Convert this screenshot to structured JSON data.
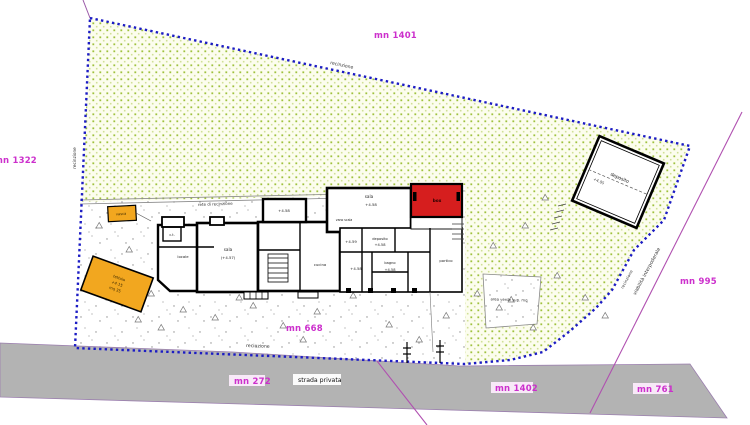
{
  "labels": {
    "mn_1401": "mn 1401",
    "mn_1322": "mn 1322",
    "mn_995": "mn 995",
    "mn_668": "mn 668",
    "mn_272": "mn 272",
    "mn_1402": "mn 1402",
    "mn_761": "mn 761"
  },
  "roads": {
    "strada_privata": "strada privata",
    "viabilita_interpoderale": "viabilità interpoderale"
  },
  "fence": {
    "recinzione_top": "recinzione",
    "recinzione_left": "recinzione",
    "recinzione_bottom": "recinzione",
    "recinzione_right": "recinzione",
    "rete_di_recinzione": "rete di recinzione"
  },
  "green_patch_note": "area verde sup. mq",
  "rooms": [
    {
      "text": "c.t."
    },
    {
      "text": "locale"
    },
    {
      "text": "sala"
    },
    {
      "text": "(+4.57)"
    },
    {
      "text": "+4.58"
    },
    {
      "text": "cucina"
    },
    {
      "text": "vano scala"
    },
    {
      "text": "sala"
    },
    {
      "text": "+4.58"
    },
    {
      "text": "+4.59"
    },
    {
      "text": "deposito"
    },
    {
      "text": "+4.58"
    },
    {
      "text": "+4.58"
    },
    {
      "text": "bagno"
    },
    {
      "text": "+4.58"
    },
    {
      "text": "portico"
    },
    {
      "text": "box"
    }
  ],
  "outbuildings": {
    "garage_label": "deposito",
    "garage_level": "+4.05",
    "tank_label": "vasca",
    "shed_line1": "tettoia",
    "shed_line2": "+4.15",
    "shed_line3": "mq 35"
  },
  "colors": {
    "boundary_blue": "#1c1cc4",
    "green_dot": "#9fc13d",
    "magenta_label": "#cc2fcc",
    "magenta_line": "#b050b0",
    "road_gray": "#b3b3b3",
    "orange": "#f2a71f",
    "red_room": "#d61e1e"
  }
}
